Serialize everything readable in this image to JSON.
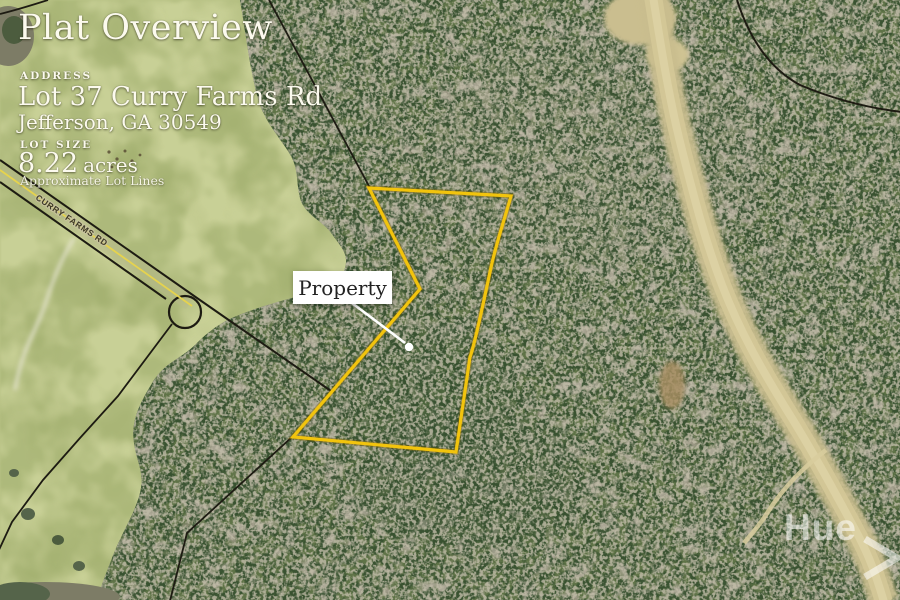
{
  "header": {
    "title": "Plat Overview",
    "address_label": "ADDRESS",
    "address_line1": "Lot 37 Curry Farms Rd",
    "address_line2": "Jefferson, GA 30549",
    "lot_size_label": "LOT SIZE",
    "lot_size_value": "8.22",
    "lot_size_unit": "acres",
    "lot_size_note": "Approximate Lot Lines"
  },
  "map": {
    "road_label": "CURRY FARMS RD",
    "callout": {
      "label": "Property"
    },
    "boundary_color": "#F2C40D"
  },
  "watermark": {
    "text": "Hue"
  }
}
